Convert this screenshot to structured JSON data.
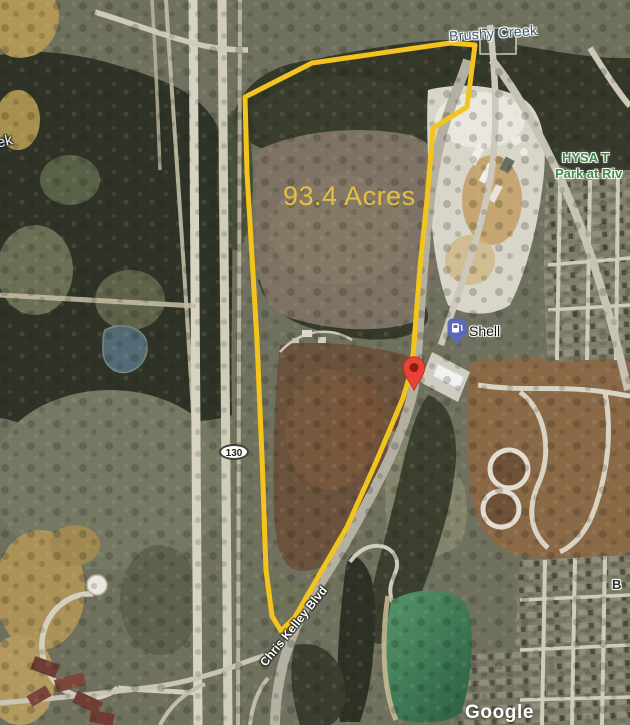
{
  "map": {
    "provider": "Google",
    "view": "satellite",
    "property": {
      "area_label": "93.4 Acres",
      "boundary_color": "#f2c41d"
    },
    "labels": {
      "creek": "Brushy Creek",
      "creek_fragment": "ek",
      "park_line1": "HYSA T",
      "park_line2": "Park at Riv",
      "street_fragment": "B"
    },
    "roads": {
      "highway_shield": "130",
      "boulevard": "Chris Kelley Blvd"
    },
    "poi": {
      "shell": "Shell"
    },
    "watermark": "Google",
    "colors": {
      "boundary": "#f2c41d",
      "area_text": "#e5c040",
      "water_text": "#3b586c",
      "park_text": "#3e8d42",
      "pond": "#3f7a55",
      "pin_red": "#e94335",
      "pin_shell": "#5b69bd"
    }
  }
}
